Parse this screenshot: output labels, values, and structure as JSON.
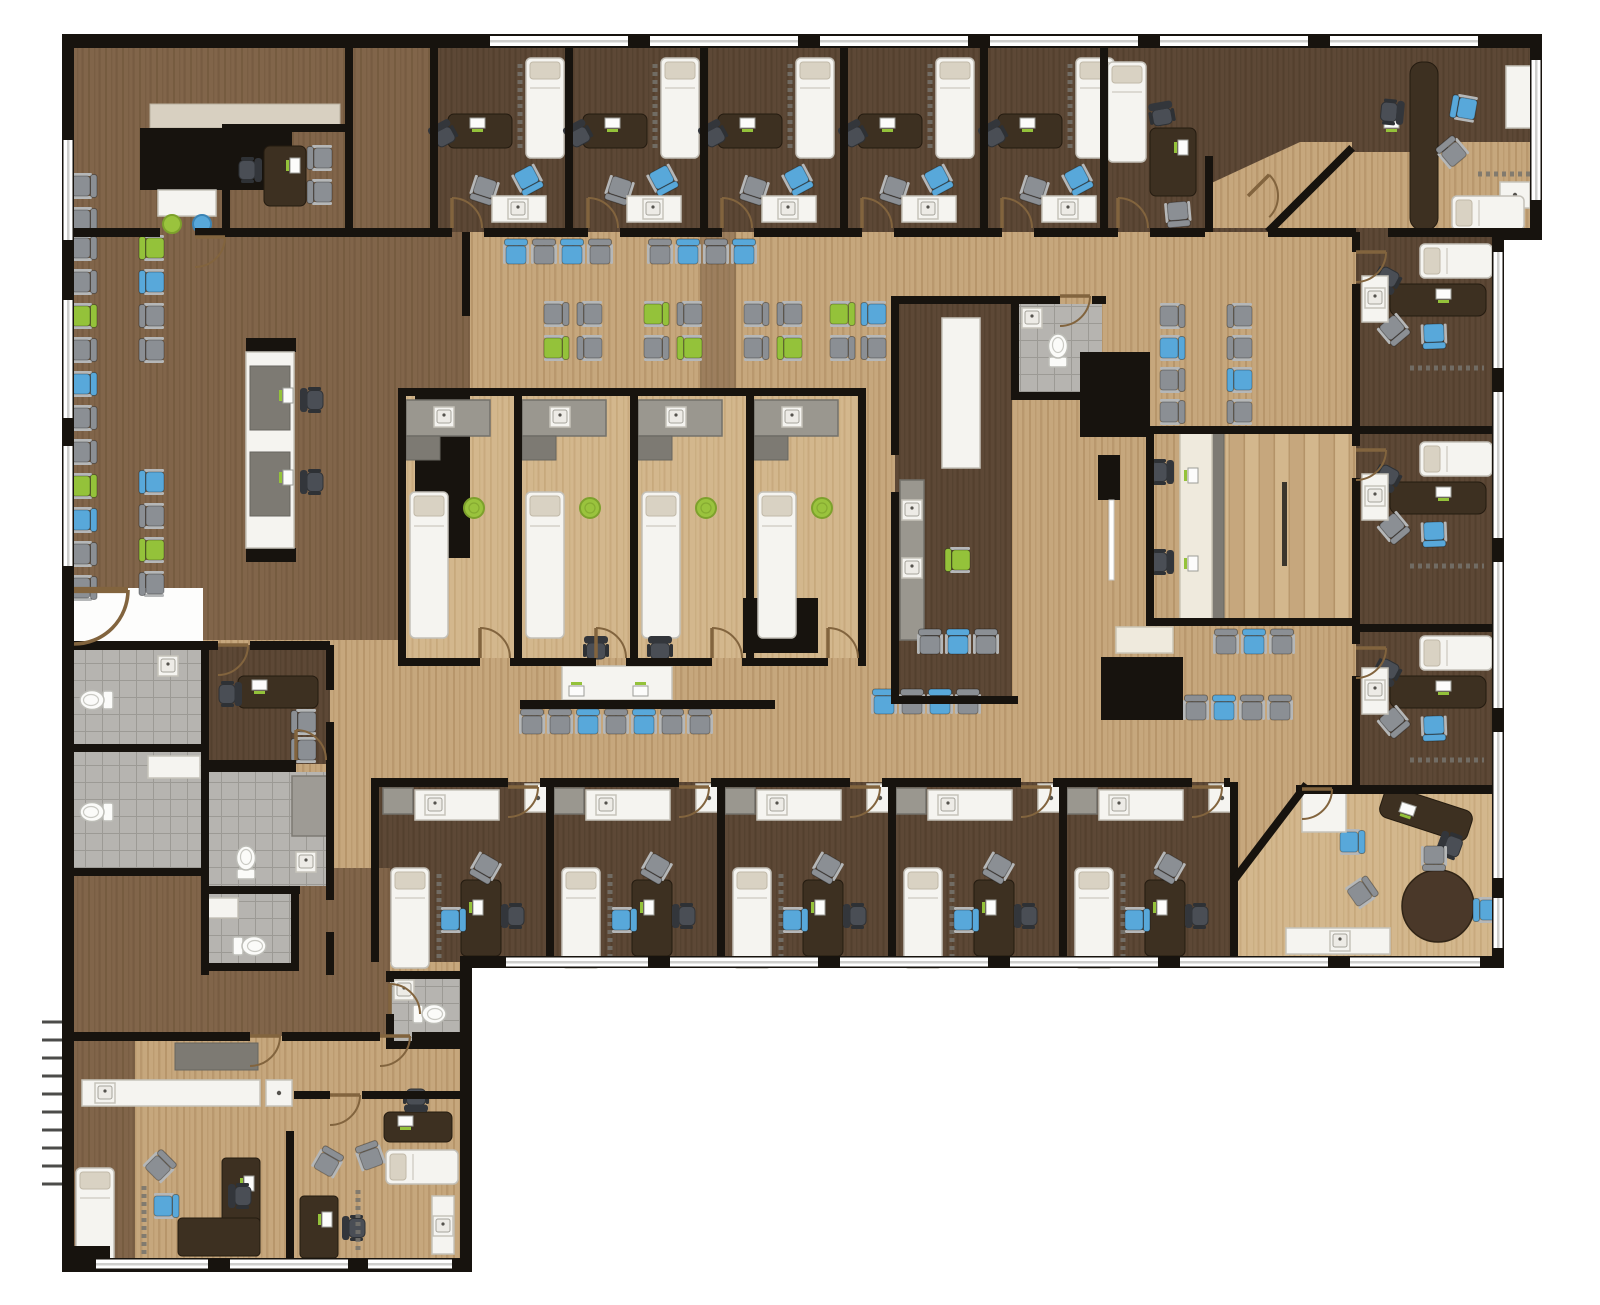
{
  "scene": {
    "type": "architectural-floor-plan",
    "view": "top-down rendered plan",
    "subject": "medical office / clinic suite",
    "visible_text": []
  },
  "palette": {
    "wall": "#17130e",
    "wood_light": "#c6a77d",
    "wood_light_s": "#a8865a",
    "wood_pale": "#d3b78d",
    "wood_pale_s": "#bb9c6c",
    "wood_mid": "#81654a",
    "wood_mid_s": "#6d5339",
    "wood_dark": "#5d4836",
    "wood_dark_s": "#4c3a28",
    "desk": "#3d3021",
    "counter": "#9a978f",
    "counter_dark": "#7d7a73",
    "tile": "#b6b4b0",
    "tile_line": "#96948e",
    "white_furniture": "#f5f4f0",
    "cream": "#efeadd",
    "tan": "#d8d0c1",
    "glass": "#cfcfcd",
    "door_arc": "#82643e",
    "chair_blue": "#58a8da",
    "chair_green": "#94c23a",
    "chair_gray": "#8b8f94",
    "chair_dark": "#43464c",
    "stool_green": "#9ac33d"
  },
  "elements": {
    "rooms": [
      "waiting-area",
      "reception-desk",
      "consult-office",
      "exam-room",
      "lab-workroom",
      "nurse-station",
      "restroom",
      "private-office",
      "break-room",
      "corridor",
      "stair"
    ],
    "furniture": [
      "guest-chair",
      "office-chair",
      "exam-table",
      "desk",
      "counter",
      "sink",
      "toilet",
      "shower",
      "round-table",
      "stool",
      "monitor",
      "floor-mat",
      "door-swing",
      "window"
    ]
  }
}
